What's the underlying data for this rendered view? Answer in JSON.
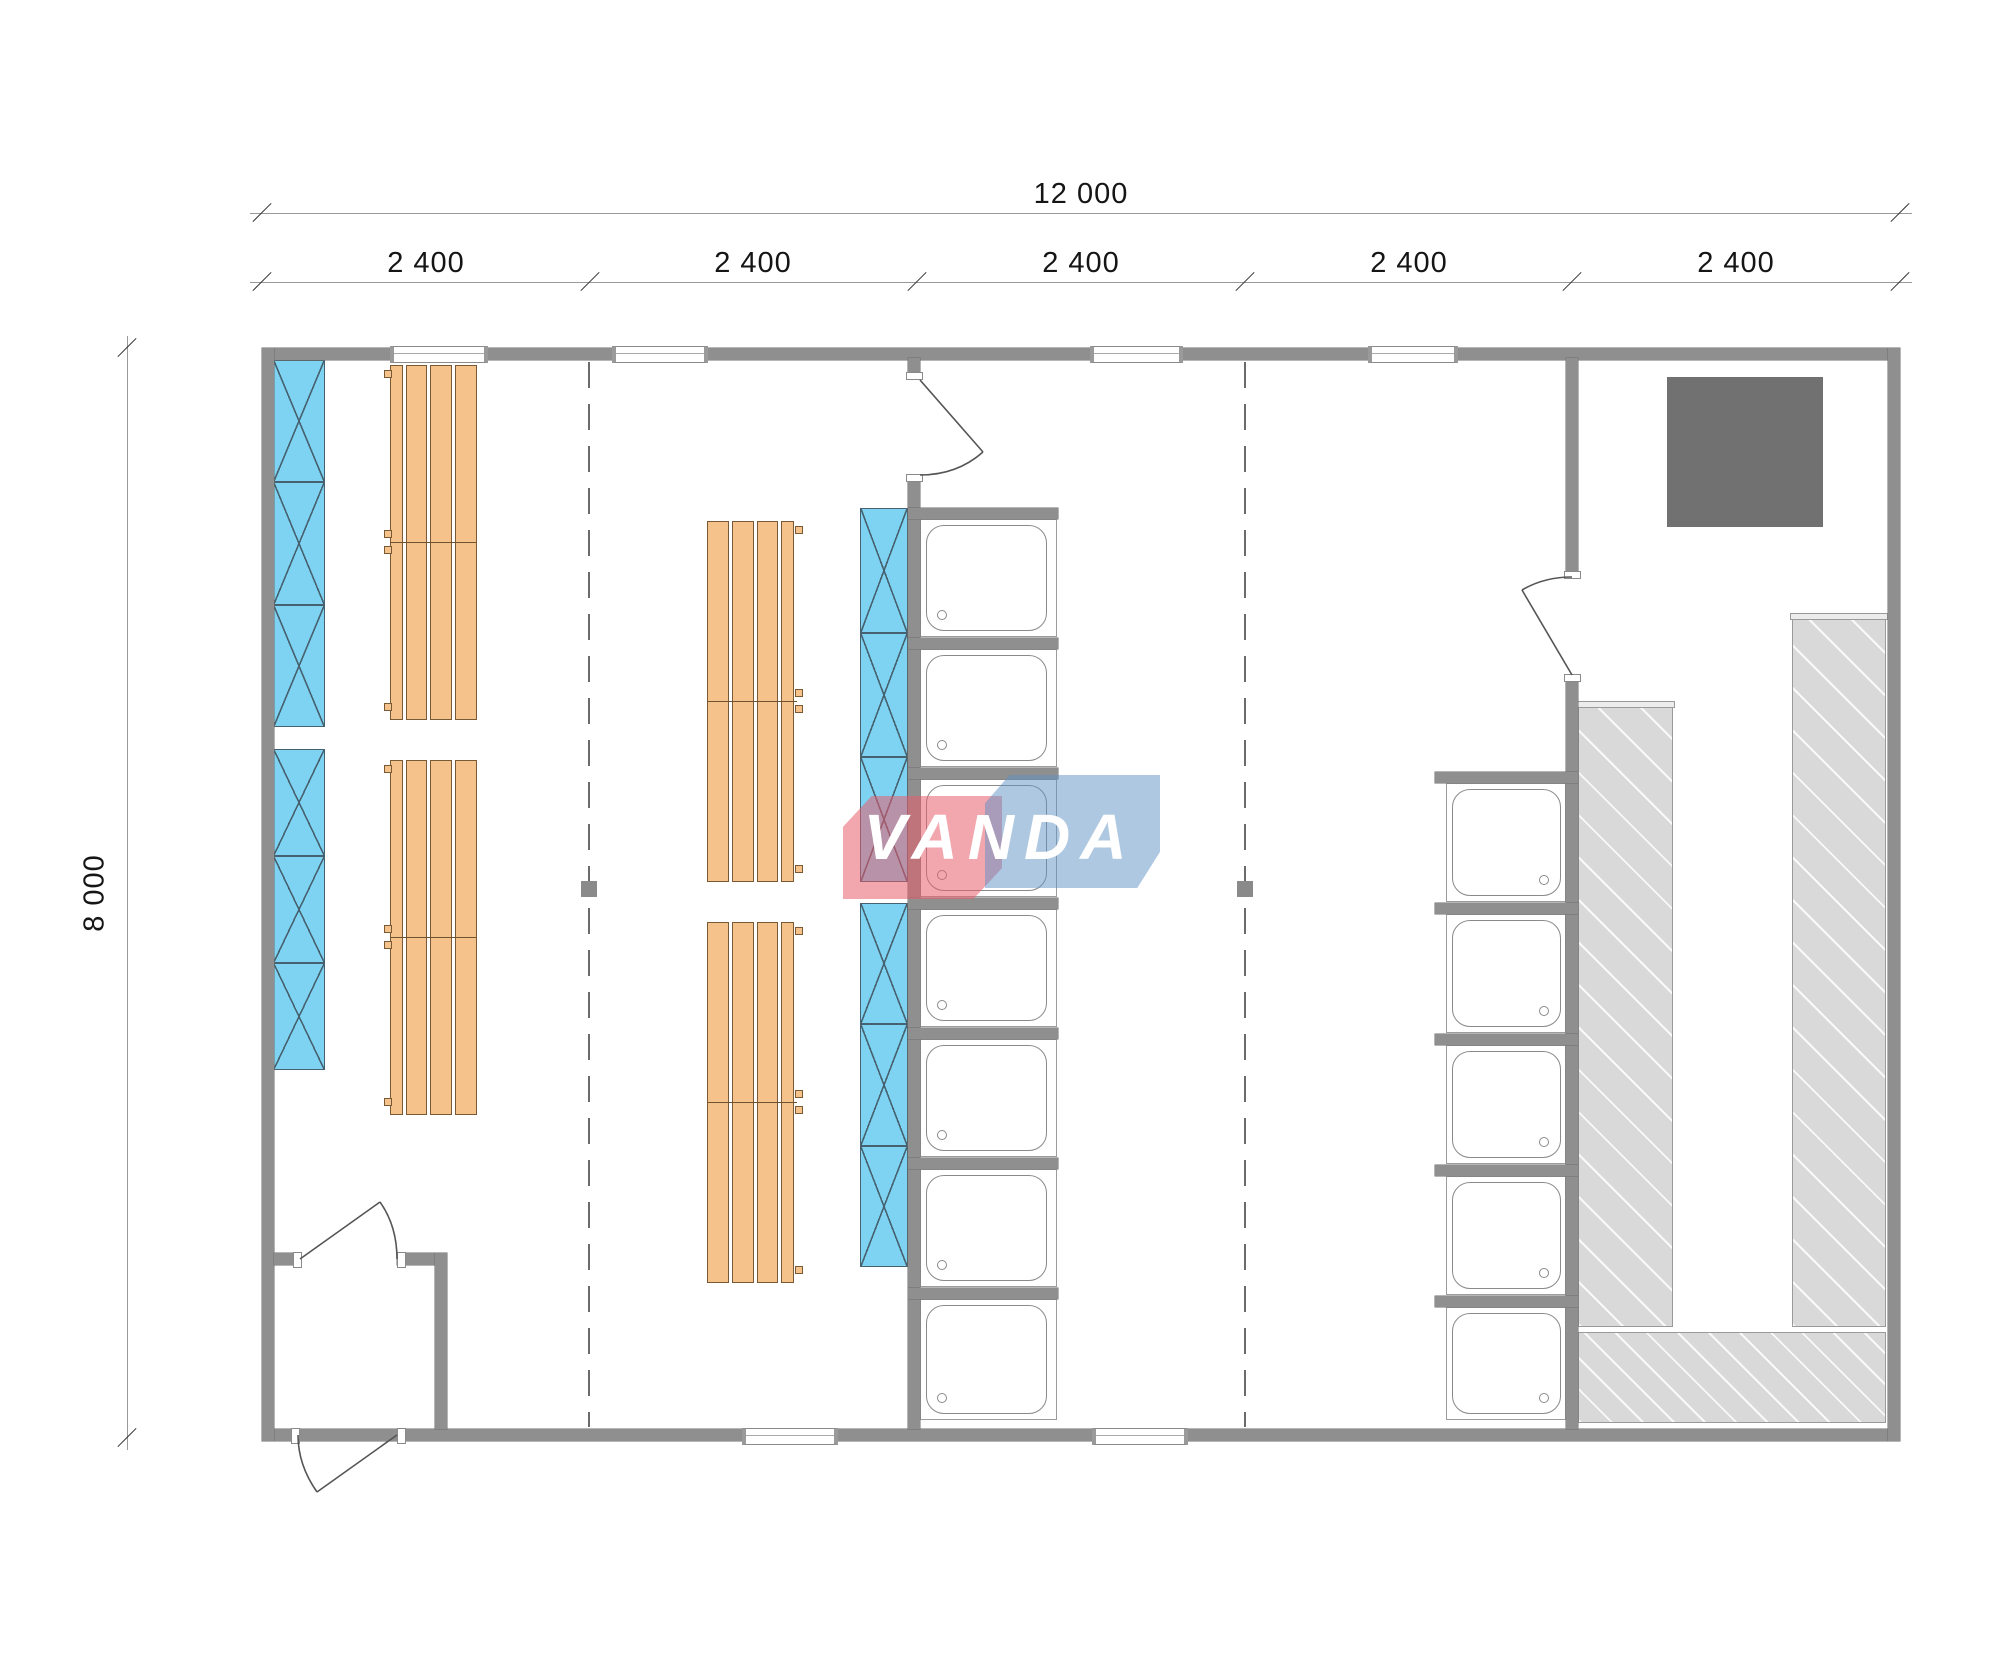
{
  "title": "VANDA sauna module floor plan",
  "dimensions": {
    "total_width": {
      "label": "12 000"
    },
    "total_height": {
      "label": "8 000"
    },
    "bays": [
      {
        "label": "2 400"
      },
      {
        "label": "2 400"
      },
      {
        "label": "2 400"
      },
      {
        "label": "2 400"
      },
      {
        "label": "2 400"
      }
    ]
  },
  "logo": {
    "text": "VANDA",
    "red": "#e85c6c",
    "blue": "#6092c6"
  },
  "colors": {
    "wall": "#8f8f8f",
    "bench_wood": "#f6c28b",
    "heater_panel": "#7dd3f1",
    "pool_deck": "#d9d9d9",
    "stove": "#717171",
    "background": "#ffffff"
  },
  "plan": {
    "bays_count": 5,
    "showers_middle_count": 7,
    "showers_right_count": 5,
    "bench_groups_count": 4,
    "heater_panels_count": 4,
    "doors_count": 4,
    "windows_top_count": 4,
    "windows_bottom_count": 2
  }
}
